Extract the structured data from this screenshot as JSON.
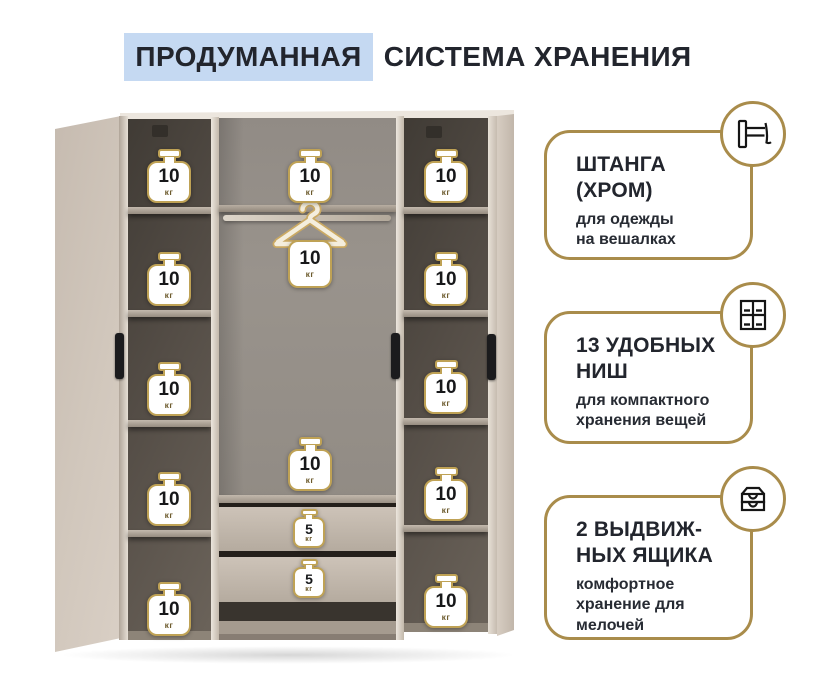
{
  "title": {
    "highlight": "ПРОДУМАННАЯ",
    "rest": "СИСТЕМА ХРАНЕНИЯ"
  },
  "features": [
    {
      "icon": "hanging-rod-icon",
      "title_lines": [
        "ШТАНГА",
        "(ХРОМ)"
      ],
      "subtitle_lines": [
        "для одежды",
        "на вешалках"
      ]
    },
    {
      "icon": "niches-grid-icon",
      "title_lines": [
        "13 УДОБНЫХ",
        "НИШ"
      ],
      "subtitle_lines": [
        "для компактного",
        "хранения вещей"
      ]
    },
    {
      "icon": "drawers-icon",
      "title_lines": [
        "2 ВЫДВИЖ-",
        "НЫХ ЯЩИКА"
      ],
      "subtitle_lines": [
        "комфортное",
        "хранение для",
        "мелочей"
      ]
    }
  ],
  "wardrobe": {
    "left_shelf_weights": [
      {
        "value": "10",
        "unit": "кг"
      },
      {
        "value": "10",
        "unit": "кг"
      },
      {
        "value": "10",
        "unit": "кг"
      },
      {
        "value": "10",
        "unit": "кг"
      },
      {
        "value": "10",
        "unit": "кг"
      }
    ],
    "right_shelf_weights": [
      {
        "value": "10",
        "unit": "кг"
      },
      {
        "value": "10",
        "unit": "кг"
      },
      {
        "value": "10",
        "unit": "кг"
      },
      {
        "value": "10",
        "unit": "кг"
      },
      {
        "value": "10",
        "unit": "кг"
      }
    ],
    "center": {
      "top_shelf_weight": {
        "value": "10",
        "unit": "кг"
      },
      "hanger_weight": {
        "value": "10",
        "unit": "кг"
      },
      "bottom_shelf_weight": {
        "value": "10",
        "unit": "кг"
      },
      "drawer_weights": [
        {
          "value": "5",
          "unit": "кг"
        },
        {
          "value": "5",
          "unit": "кг"
        }
      ]
    }
  },
  "colors": {
    "gold": "#a98c4b",
    "weight_gold": "#bfa255",
    "highlight_blue": "#c5d9f2",
    "text_dark": "#22252d",
    "door_beige": "#cfc5ba",
    "interior_dark": "#544d46"
  }
}
